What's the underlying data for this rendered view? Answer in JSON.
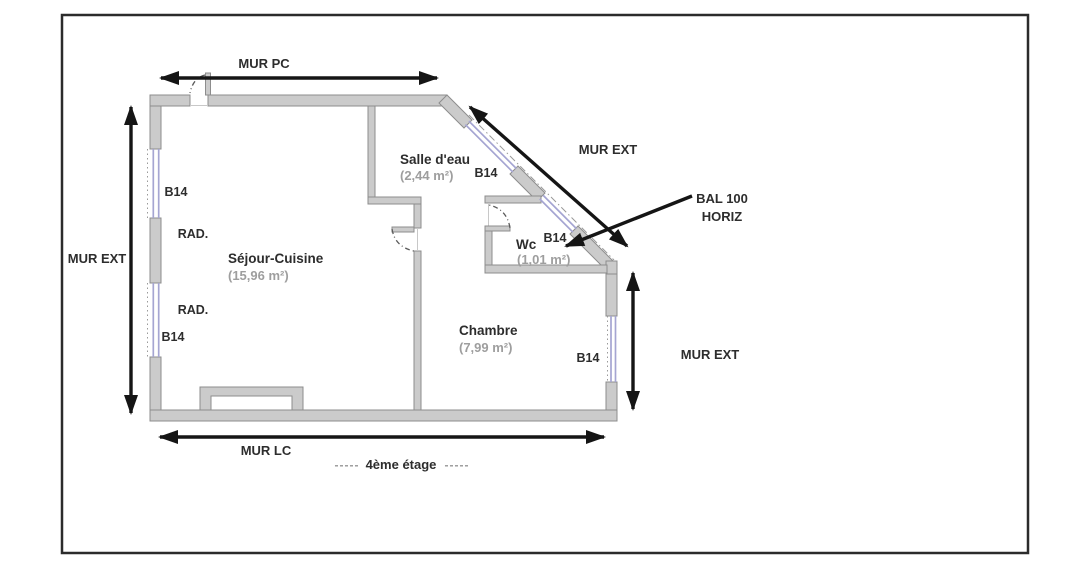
{
  "plan": {
    "colors": {
      "wall-fill": "#cbcbcb",
      "wall-stroke": "#8d8d8d",
      "window-color": "#a5a5d2",
      "axis-color": "#9a9a9a",
      "arrow-color": "#151515",
      "swing-color": "#5a5a5a",
      "text-color": "#2d2d2d",
      "area-color": "#9e9e9e",
      "thresh-color": "#c8c8c8",
      "frame-color": "#2b2b2b"
    },
    "dimension_labels": {
      "top": "MUR PC",
      "left": "MUR EXT",
      "diagonal": "MUR EXT",
      "right": "MUR EXT",
      "bottom": "MUR LC"
    },
    "balcony_annotation": {
      "line1": "BAL 100",
      "line2": "HORIZ"
    },
    "rooms": {
      "sejour_cuisine": {
        "name": "Séjour-Cuisine",
        "area": "(15,96 m²)"
      },
      "salle_eau": {
        "name": "Salle d'eau",
        "area": "(2,44 m²)"
      },
      "wc": {
        "name": "Wc",
        "area": "(1,01 m²)"
      },
      "chambre": {
        "name": "Chambre",
        "area": "(7,99 m²)"
      }
    },
    "window_labels": {
      "left_upper": "B14",
      "left_lower": "B14",
      "diagonal_upper": "B14",
      "diagonal_lower": "B14",
      "right": "B14"
    },
    "radiator_labels": {
      "upper": "RAD.",
      "lower": "RAD."
    },
    "caption": {
      "left_dashes": "-----",
      "text": "4ème étage",
      "right_dashes": "-----"
    }
  }
}
